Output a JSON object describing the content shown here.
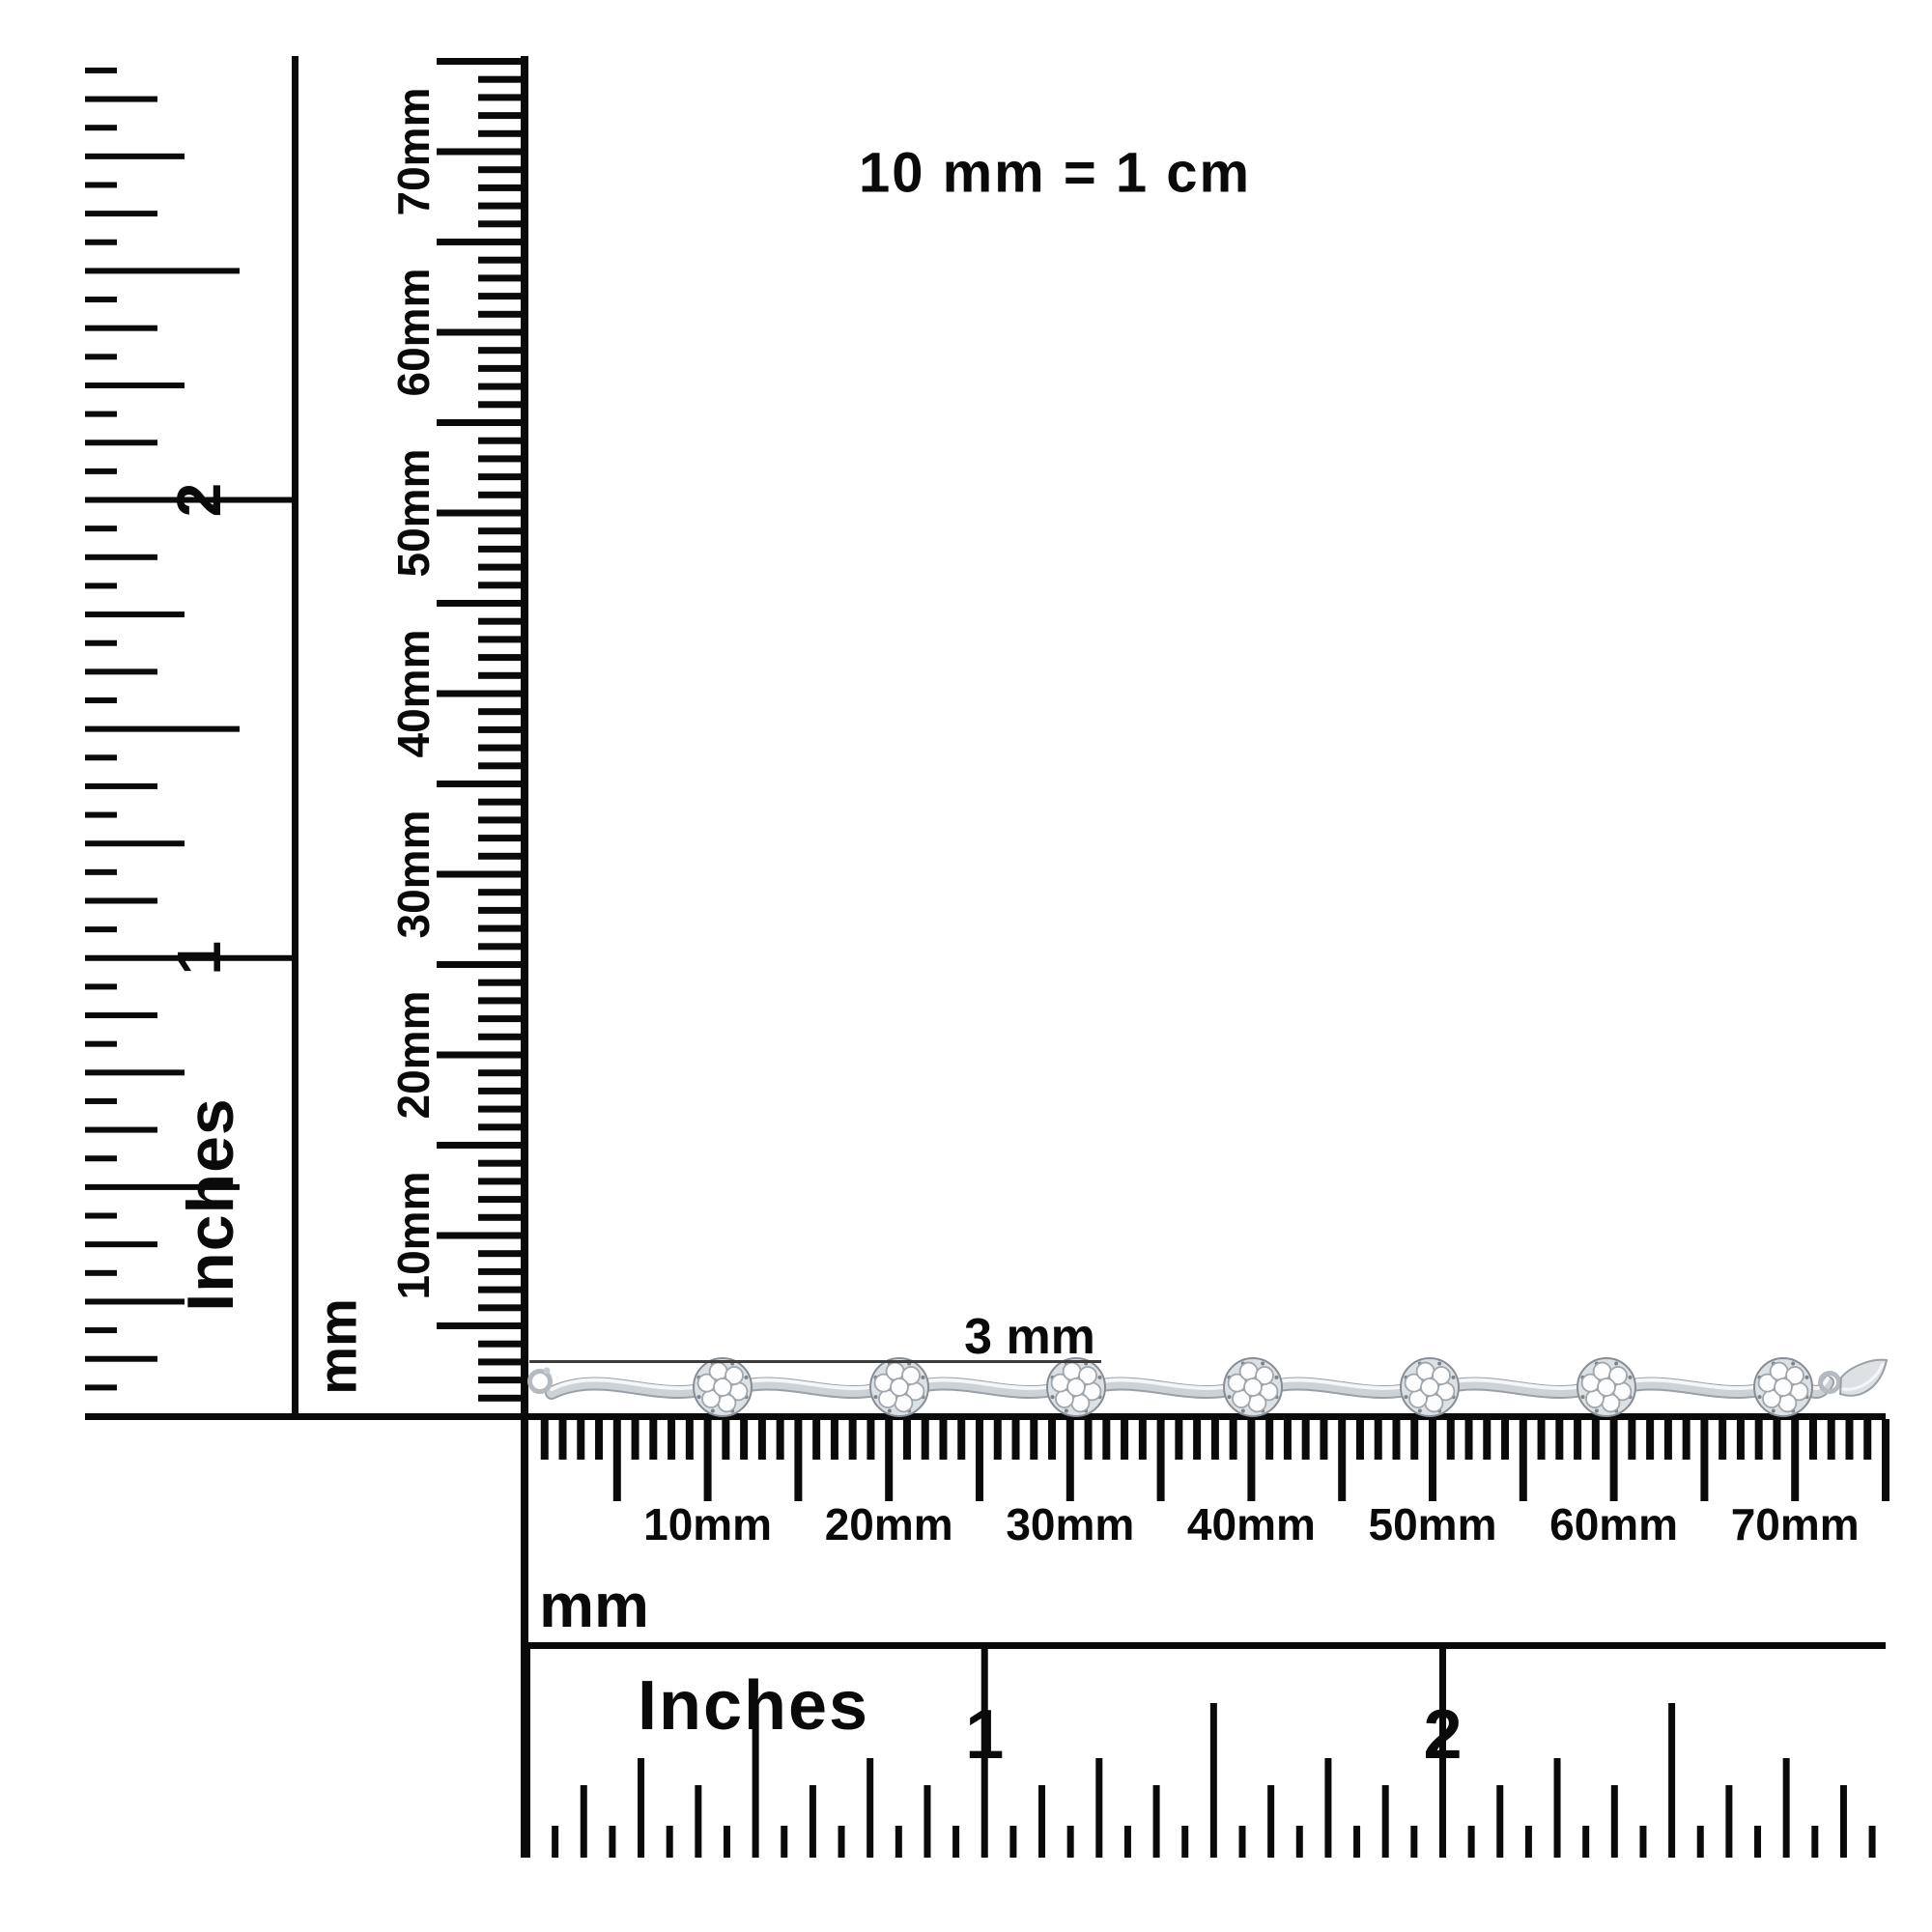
{
  "scale_note": "10 mm = 1 cm",
  "annotation": {
    "label": "3 mm"
  },
  "left_inch_ruler": {
    "unit": "Inches",
    "numbers": [
      "1",
      "2"
    ]
  },
  "left_mm_ruler": {
    "unit": "mm",
    "labels": [
      "10mm",
      "20mm",
      "30mm",
      "40mm",
      "50mm",
      "60mm",
      "70mm"
    ]
  },
  "bottom_mm_ruler": {
    "unit": "mm",
    "labels": [
      "10mm",
      "20mm",
      "30mm",
      "40mm",
      "50mm",
      "60mm",
      "70mm"
    ]
  },
  "bottom_inch_ruler": {
    "unit": "Inches",
    "numbers": [
      "1",
      "2"
    ]
  },
  "bracelet": {
    "station_count": 7
  },
  "colors": {
    "ink": "#0a0a0a",
    "annotation_line": "#3c3c3c",
    "metal_edge": "#9aa0a6",
    "metal_mid": "#ccd2d6",
    "metal_light": "#f4f6f7",
    "cluster_base": "#dde1e4",
    "cluster_rim": "#878d94",
    "stone": "#fdfdfe",
    "stone_edge": "#9fa6ac",
    "prong": "#7d838a"
  }
}
